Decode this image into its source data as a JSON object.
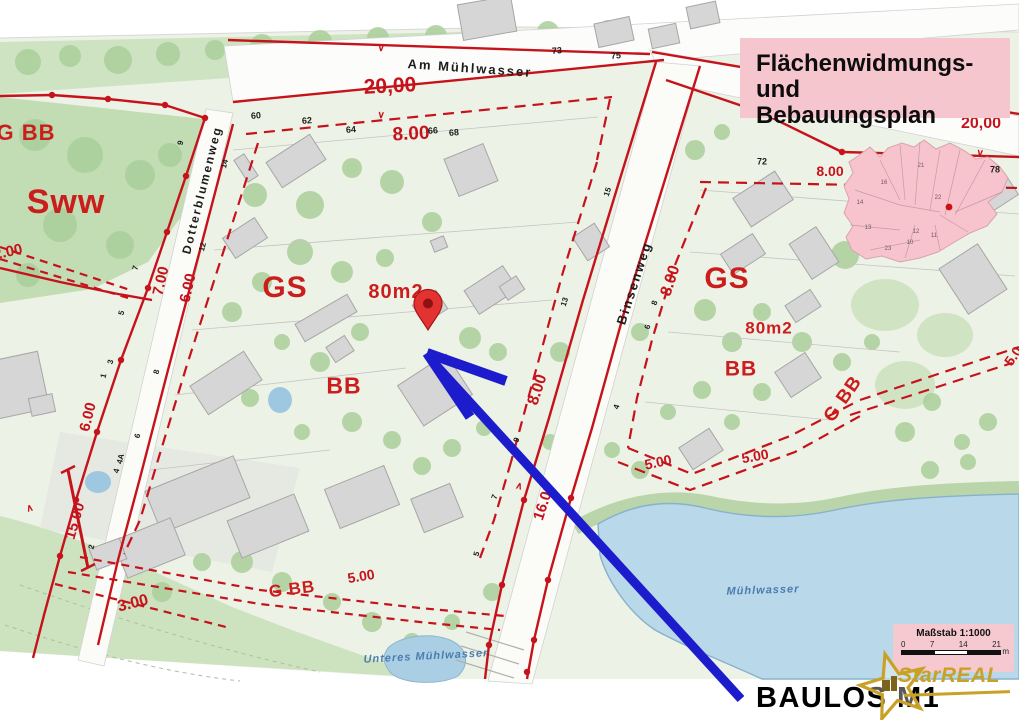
{
  "title_box": {
    "line1": "Flächenwidmungs- und",
    "line2": "Bebauungsplan"
  },
  "annotation": {
    "label": "BAULOS M1"
  },
  "logo": {
    "brand": "StarREAL"
  },
  "scalebar": {
    "title": "Maßstab 1:1000",
    "ticks": [
      "0",
      "7",
      "14",
      "21"
    ],
    "unit": "m"
  },
  "colors": {
    "zoning_red": "#c6121a",
    "water_blue": "#b9d8e9",
    "panel_pink": "#f6c6ce",
    "arrow_blue": "#1c1ccd",
    "logo_gold": "#c9a127",
    "building_grey": "#d6d6d6",
    "park_green": "#cde3c2"
  },
  "map": {
    "streets": [
      "Am Mühlwasser",
      "Dotterblumenweg",
      "Binsenweg"
    ],
    "waters": [
      "Mühlwasser",
      "Unteres Mühlwasser"
    ],
    "zone_codes": [
      "Sww",
      "GS",
      "BB",
      "G BB",
      "80m2"
    ],
    "labels": [
      {
        "t": "Am Mühlwasser",
        "x": 470,
        "y": 68,
        "r": 4,
        "s": 13,
        "c": "street",
        "n": "street-label-am-muehlwasser"
      },
      {
        "t": "Dotterblumenweg",
        "x": 202,
        "y": 190,
        "r": -76,
        "s": 12,
        "c": "street",
        "n": "street-label-dotterblumenweg"
      },
      {
        "t": "Binsenweg",
        "x": 634,
        "y": 283,
        "r": -72,
        "s": 13,
        "c": "street",
        "n": "street-label-binsenweg"
      },
      {
        "t": "Mühlwasser",
        "x": 763,
        "y": 591,
        "r": -2,
        "s": 11,
        "c": "water",
        "n": "water-label-muehlwasser"
      },
      {
        "t": "Unteres Mühlwasser",
        "x": 426,
        "y": 657,
        "r": -3,
        "s": 11,
        "c": "water",
        "n": "water-label-unteres-muehlwasser"
      },
      {
        "t": "Sww",
        "x": 66,
        "y": 202,
        "r": 0,
        "s": 34,
        "c": "zone",
        "n": "zone-label-sww"
      },
      {
        "t": "G BB",
        "x": 26,
        "y": 133,
        "r": 0,
        "s": 22,
        "c": "zone",
        "n": "zone-label-gbb-topleft"
      },
      {
        "t": "GS",
        "x": 285,
        "y": 288,
        "r": 0,
        "s": 30,
        "c": "zone",
        "n": "zone-label-gs-left"
      },
      {
        "t": "GS",
        "x": 727,
        "y": 279,
        "r": 0,
        "s": 30,
        "c": "zone",
        "n": "zone-label-gs-right"
      },
      {
        "t": "BB",
        "x": 344,
        "y": 386,
        "r": 0,
        "s": 23,
        "c": "zone",
        "n": "zone-label-bb-left"
      },
      {
        "t": "BB",
        "x": 741,
        "y": 369,
        "r": 0,
        "s": 21,
        "c": "zone",
        "n": "zone-label-bb-right"
      },
      {
        "t": "80m2",
        "x": 396,
        "y": 292,
        "r": 0,
        "s": 20,
        "c": "zone",
        "n": "zone-label-80m2-left"
      },
      {
        "t": "80m2",
        "x": 769,
        "y": 328,
        "r": 0,
        "s": 17,
        "c": "zone",
        "n": "zone-label-80m2-right"
      },
      {
        "t": "G BB",
        "x": 292,
        "y": 589,
        "r": -7,
        "s": 17,
        "c": "zone",
        "n": "zone-label-gbb-bottom"
      },
      {
        "t": "G BB",
        "x": 843,
        "y": 399,
        "r": -55,
        "s": 19,
        "c": "zone",
        "n": "zone-label-gbb-right"
      },
      {
        "t": "20,00",
        "x": 390,
        "y": 86,
        "r": -3,
        "s": 21,
        "c": "meas"
      },
      {
        "t": "20,00",
        "x": 981,
        "y": 124,
        "r": 0,
        "s": 16,
        "c": "meas"
      },
      {
        "t": "8.00",
        "x": 411,
        "y": 134,
        "r": -3,
        "s": 19,
        "c": "meas"
      },
      {
        "t": "8.00",
        "x": 830,
        "y": 171,
        "r": 0,
        "s": 14,
        "c": "meas"
      },
      {
        "t": "8.00",
        "x": 671,
        "y": 281,
        "r": -72,
        "s": 16,
        "c": "meas"
      },
      {
        "t": "8.00",
        "x": 538,
        "y": 390,
        "r": -72,
        "s": 16,
        "c": "meas"
      },
      {
        "t": "7.00",
        "x": 161,
        "y": 281,
        "r": -77,
        "s": 15,
        "c": "meas"
      },
      {
        "t": "6.00",
        "x": 188,
        "y": 288,
        "r": -77,
        "s": 15,
        "c": "meas"
      },
      {
        "t": "6.00",
        "x": 88,
        "y": 417,
        "r": -76,
        "s": 15,
        "c": "meas"
      },
      {
        "t": "2.00",
        "x": 8,
        "y": 252,
        "r": -12,
        "s": 15,
        "c": "meas"
      },
      {
        "t": "15.00",
        "x": 75,
        "y": 521,
        "r": -74,
        "s": 15,
        "c": "meas"
      },
      {
        "t": "3.00",
        "x": 133,
        "y": 604,
        "r": -14,
        "s": 16,
        "c": "meas"
      },
      {
        "t": "5.00",
        "x": 361,
        "y": 576,
        "r": -9,
        "s": 14,
        "c": "meas"
      },
      {
        "t": "5.00",
        "x": 658,
        "y": 462,
        "r": -12,
        "s": 14,
        "c": "meas"
      },
      {
        "t": "5.00",
        "x": 755,
        "y": 456,
        "r": -10,
        "s": 14,
        "c": "meas"
      },
      {
        "t": "16.00",
        "x": 544,
        "y": 502,
        "r": -72,
        "s": 15,
        "c": "meas"
      },
      {
        "t": "5.0",
        "x": 1013,
        "y": 356,
        "r": -55,
        "s": 14,
        "c": "meas"
      },
      {
        "t": "60",
        "x": 256,
        "y": 116,
        "r": -4,
        "s": 9,
        "c": "hn"
      },
      {
        "t": "62",
        "x": 307,
        "y": 121,
        "r": -4,
        "s": 9,
        "c": "hn"
      },
      {
        "t": "64",
        "x": 351,
        "y": 130,
        "r": -4,
        "s": 9,
        "c": "hn"
      },
      {
        "t": "66",
        "x": 433,
        "y": 131,
        "r": -4,
        "s": 9,
        "c": "hn"
      },
      {
        "t": "68",
        "x": 454,
        "y": 133,
        "r": -4,
        "s": 9,
        "c": "hn"
      },
      {
        "t": "73",
        "x": 557,
        "y": 51,
        "r": -4,
        "s": 9,
        "c": "hn"
      },
      {
        "t": "75",
        "x": 616,
        "y": 56,
        "r": -4,
        "s": 9,
        "c": "hn"
      },
      {
        "t": "72",
        "x": 762,
        "y": 162,
        "r": 0,
        "s": 9,
        "c": "hn"
      },
      {
        "t": "78",
        "x": 995,
        "y": 170,
        "r": 0,
        "s": 9,
        "c": "hn"
      },
      {
        "t": "9",
        "x": 181,
        "y": 143,
        "r": -76,
        "s": 8,
        "c": "hn"
      },
      {
        "t": "14",
        "x": 225,
        "y": 164,
        "r": -76,
        "s": 8,
        "c": "hn"
      },
      {
        "t": "12",
        "x": 203,
        "y": 247,
        "r": -76,
        "s": 8,
        "c": "hn"
      },
      {
        "t": "7",
        "x": 136,
        "y": 268,
        "r": -76,
        "s": 8,
        "c": "hn"
      },
      {
        "t": "5",
        "x": 122,
        "y": 313,
        "r": -76,
        "s": 8,
        "c": "hn"
      },
      {
        "t": "3",
        "x": 111,
        "y": 362,
        "r": -76,
        "s": 8,
        "c": "hn"
      },
      {
        "t": "1",
        "x": 104,
        "y": 376,
        "r": -76,
        "s": 8,
        "c": "hn"
      },
      {
        "t": "8",
        "x": 157,
        "y": 372,
        "r": -76,
        "s": 8,
        "c": "hn"
      },
      {
        "t": "6",
        "x": 138,
        "y": 436,
        "r": -76,
        "s": 8,
        "c": "hn"
      },
      {
        "t": "4A",
        "x": 121,
        "y": 459,
        "r": -76,
        "s": 8,
        "c": "hn"
      },
      {
        "t": "4",
        "x": 117,
        "y": 471,
        "r": -76,
        "s": 8,
        "c": "hn"
      },
      {
        "t": "2",
        "x": 92,
        "y": 547,
        "r": -76,
        "s": 8,
        "c": "hn"
      },
      {
        "t": "15",
        "x": 608,
        "y": 192,
        "r": -72,
        "s": 8,
        "c": "hn"
      },
      {
        "t": "13",
        "x": 565,
        "y": 302,
        "r": -72,
        "s": 8,
        "c": "hn"
      },
      {
        "t": "9",
        "x": 517,
        "y": 440,
        "r": -72,
        "s": 8,
        "c": "hn"
      },
      {
        "t": "7",
        "x": 495,
        "y": 497,
        "r": -72,
        "s": 8,
        "c": "hn"
      },
      {
        "t": "5",
        "x": 477,
        "y": 554,
        "r": -72,
        "s": 8,
        "c": "hn"
      },
      {
        "t": "8",
        "x": 655,
        "y": 303,
        "r": -72,
        "s": 8,
        "c": "hn"
      },
      {
        "t": "6",
        "x": 648,
        "y": 327,
        "r": -72,
        "s": 8,
        "c": "hn"
      },
      {
        "t": "4",
        "x": 617,
        "y": 407,
        "r": -72,
        "s": 8,
        "c": "hn"
      },
      {
        "t": "∨",
        "x": 381,
        "y": 49,
        "r": 4,
        "s": 10,
        "c": "caret",
        "n": "line-caret"
      },
      {
        "t": "∨",
        "x": 381,
        "y": 116,
        "r": 4,
        "s": 10,
        "c": "caret",
        "n": "line-caret"
      },
      {
        "t": "∨",
        "x": 980,
        "y": 154,
        "r": 6,
        "s": 10,
        "c": "caret",
        "n": "line-caret"
      },
      {
        "t": "∧",
        "x": 30,
        "y": 509,
        "r": -14,
        "s": 10,
        "c": "caret",
        "n": "line-caret"
      },
      {
        "t": "∧",
        "x": 519,
        "y": 487,
        "r": 16,
        "s": 10,
        "c": "caret",
        "n": "line-caret"
      },
      {
        "t": "21",
        "x": 921,
        "y": 166,
        "r": 0,
        "s": 6,
        "c": "inset",
        "n": "inset-district-number"
      },
      {
        "t": "22",
        "x": 938,
        "y": 198,
        "r": 0,
        "s": 6,
        "c": "inset",
        "n": "inset-district-number"
      },
      {
        "t": "14",
        "x": 860,
        "y": 203,
        "r": 0,
        "s": 6,
        "c": "inset",
        "n": "inset-district-number"
      },
      {
        "t": "16",
        "x": 884,
        "y": 183,
        "r": 0,
        "s": 6,
        "c": "inset",
        "n": "inset-district-number"
      },
      {
        "t": "13",
        "x": 868,
        "y": 228,
        "r": 0,
        "s": 6,
        "c": "inset",
        "n": "inset-district-number"
      },
      {
        "t": "23",
        "x": 888,
        "y": 249,
        "r": 0,
        "s": 6,
        "c": "inset",
        "n": "inset-district-number"
      },
      {
        "t": "10",
        "x": 910,
        "y": 243,
        "r": 0,
        "s": 6,
        "c": "inset",
        "n": "inset-district-number"
      },
      {
        "t": "12",
        "x": 916,
        "y": 232,
        "r": 0,
        "s": 6,
        "c": "inset",
        "n": "inset-district-number"
      },
      {
        "t": "11",
        "x": 934,
        "y": 236,
        "r": 0,
        "s": 6,
        "c": "inset",
        "n": "inset-district-number"
      }
    ]
  }
}
